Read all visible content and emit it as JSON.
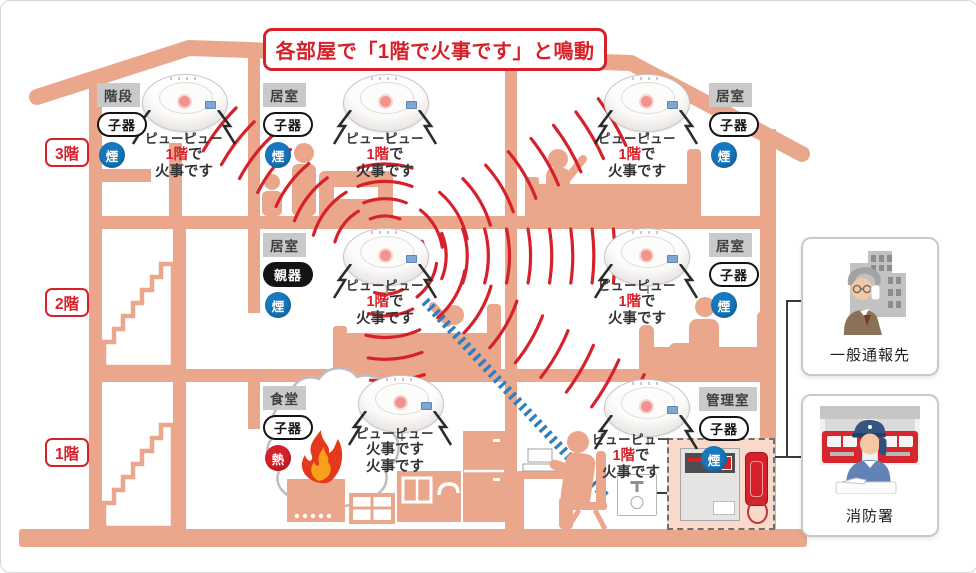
{
  "title": "各部屋で「1階で火事です」と鳴動",
  "floor_labels": [
    "3階",
    "2階",
    "1階"
  ],
  "colors": {
    "alert_red": "#D7212A",
    "building_salmon": "#EBA78C",
    "smoke_badge_blue": "#1778BE",
    "heat_badge_red": "#D7212A",
    "transfer_line_blue": "#2E7EC0"
  },
  "detectors": [
    {
      "room": "階段",
      "unit": "子器",
      "unit_type": "child",
      "sensor": "煙",
      "sensor_type": "smoke",
      "message": [
        {
          "red": "",
          "black": "ピューピュー"
        },
        {
          "red": "1階",
          "black": "で"
        },
        {
          "red": "",
          "black": "火事です"
        }
      ]
    },
    {
      "room": "居室",
      "unit": "子器",
      "unit_type": "child",
      "sensor": "煙",
      "sensor_type": "smoke",
      "message": [
        {
          "red": "",
          "black": "ピューピュー"
        },
        {
          "red": "1階",
          "black": "で"
        },
        {
          "red": "",
          "black": "火事です"
        }
      ]
    },
    {
      "room": "居室",
      "unit": "子器",
      "unit_type": "child",
      "sensor": "煙",
      "sensor_type": "smoke",
      "message": [
        {
          "red": "",
          "black": "ピューピュー"
        },
        {
          "red": "1階",
          "black": "で"
        },
        {
          "red": "",
          "black": "火事です"
        }
      ]
    },
    {
      "room": "居室",
      "unit": "親器",
      "unit_type": "parent",
      "sensor": "煙",
      "sensor_type": "smoke",
      "message": [
        {
          "red": "",
          "black": "ピューピュー"
        },
        {
          "red": "1階",
          "black": "で"
        },
        {
          "red": "",
          "black": "火事です"
        }
      ]
    },
    {
      "room": "居室",
      "unit": "子器",
      "unit_type": "child",
      "sensor": "煙",
      "sensor_type": "smoke",
      "message": [
        {
          "red": "",
          "black": "ピューピュー"
        },
        {
          "red": "1階",
          "black": "で"
        },
        {
          "red": "",
          "black": "火事です"
        }
      ]
    },
    {
      "room": "食堂",
      "unit": "子器",
      "unit_type": "child",
      "sensor": "熱",
      "sensor_type": "heat",
      "message": [
        {
          "red": "",
          "black": "ピューピュー"
        },
        {
          "red": "",
          "black": "火事です"
        },
        {
          "red": "",
          "black": "火事です"
        }
      ]
    },
    {
      "room": "管理室",
      "unit": "子器",
      "unit_type": "child",
      "sensor": "煙",
      "sensor_type": "smoke",
      "message": [
        {
          "red": "",
          "black": "ピューピュー"
        },
        {
          "red": "1階",
          "black": "で"
        },
        {
          "red": "",
          "black": "火事です"
        }
      ]
    }
  ],
  "contacts": [
    {
      "label": "一般通報先"
    },
    {
      "label": "消防署"
    }
  ]
}
